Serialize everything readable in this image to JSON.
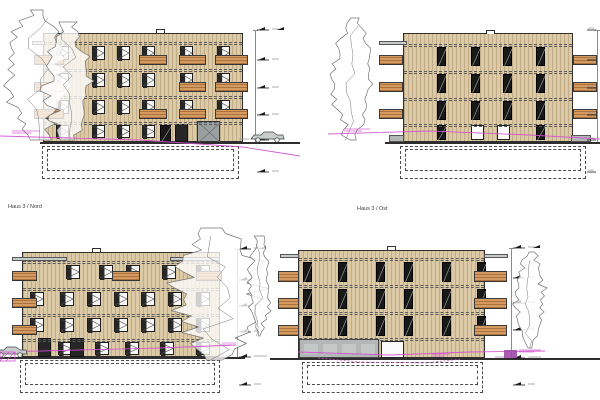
{
  "canvas": {
    "w": 600,
    "h": 400,
    "bg": "#ffffff"
  },
  "palette": {
    "facade": "#dccaa6",
    "facade_stripe": "rgba(124,96,58,0.28)",
    "outline": "#2f2f2f",
    "dashed": "#5a5a5a",
    "balcony": "#d59a5f",
    "balcony_stripe": "rgba(115,66,22,0.45)",
    "balcony_edge": "#3c3c3c",
    "window_frame": "#1f1f1f",
    "glass": "#f7f7f5",
    "sash_dark": "#262626",
    "grey": "#9aa0a0",
    "grey_light": "#c7cccb",
    "concrete": "#b3b8b7",
    "magenta": "#cf4fcf",
    "purple": "#a04aa8",
    "ground": "#2e2e2e",
    "tree": "#757575",
    "marker": "#1a1a1a",
    "marker_text": "#9a9a9a"
  },
  "views": [
    {
      "id": "elevation-top-left",
      "label": null,
      "building": {
        "x": 43,
        "y": 33,
        "w": 200,
        "h": 109
      },
      "floor_lines_y": [
        42,
        69,
        96,
        122
      ],
      "window_grids": [
        {
          "style": "casement",
          "cols": [
            56,
            92,
            117,
            142,
            180,
            217
          ],
          "rows": [
            46,
            73,
            100
          ],
          "w": 13,
          "h": 14
        },
        {
          "style": "casement",
          "cols": [
            56,
            92,
            117,
            142
          ],
          "rows": [
            125
          ],
          "w": 13,
          "h": 13
        }
      ],
      "extra_windows": [
        {
          "style": "dark",
          "x": 160,
          "y": 125,
          "w": 11,
          "h": 17
        },
        {
          "style": "door-dark",
          "x": 175,
          "y": 124,
          "w": 13,
          "h": 18
        },
        {
          "style": "door-grey",
          "x": 197,
          "y": 121,
          "w": 23,
          "h": 21
        }
      ],
      "balconies": [
        {
          "x": 34,
          "w": 30,
          "rows": [
            55,
            82,
            109
          ],
          "h": 10
        },
        {
          "x": 139,
          "w": 28,
          "rows": [
            55,
            109
          ],
          "h": 10
        },
        {
          "x": 179,
          "w": 27,
          "rows": [
            55,
            82,
            109
          ],
          "h": 10
        },
        {
          "x": 215,
          "w": 33,
          "rows": [
            55,
            82,
            109
          ],
          "h": 10
        }
      ],
      "grey_rects": [
        {
          "x": 32,
          "y": 41,
          "w": 13,
          "h": 4,
          "fill": "grey"
        }
      ],
      "vent": {
        "x": 156,
        "y": 29,
        "w": 9,
        "h": 4
      },
      "basement": {
        "x": 42,
        "y": 146,
        "w": 197,
        "h": 33
      },
      "ground": {
        "y": 142,
        "x1": 40,
        "x2": 300
      },
      "dim": {
        "x": 255,
        "y1": 30,
        "y2": 142,
        "magenta_seg": [
          88,
          112
        ]
      },
      "markers": [
        {
          "y": 30,
          "double": true
        },
        {
          "y": 60
        },
        {
          "y": 88
        },
        {
          "y": 115
        },
        {
          "y": 140,
          "long": true
        },
        {
          "y": 172
        }
      ],
      "car": {
        "x": 251,
        "y": 132
      },
      "trees": [
        {
          "x": 1,
          "y": 10,
          "w": 72,
          "h": 130,
          "seed": 11
        },
        {
          "x": 42,
          "y": 22,
          "w": 52,
          "h": 118,
          "seed": 23
        }
      ],
      "magenta_lines": [
        [
          [
            0,
            136
          ],
          [
            140,
            140
          ],
          [
            243,
            147
          ],
          [
            300,
            156
          ]
        ]
      ],
      "magenta_dashed": [],
      "magenta_marks": [
        {
          "x": 12,
          "y": 131,
          "w": 28
        }
      ]
    },
    {
      "id": "elevation-top-right",
      "label": null,
      "building": {
        "x": 403,
        "y": 33,
        "w": 170,
        "h": 109
      },
      "floor_lines_y": [
        44,
        71,
        98,
        124
      ],
      "window_grids": [
        {
          "style": "dark",
          "cols": [
            437,
            471,
            503,
            536
          ],
          "rows": [
            47,
            74,
            101
          ],
          "w": 9,
          "h": 19
        },
        {
          "style": "dark",
          "cols": [
            437,
            536
          ],
          "rows": [
            125
          ],
          "w": 9,
          "h": 15
        },
        {
          "style": "white",
          "cols": [
            471,
            497
          ],
          "rows": [
            125
          ],
          "w": 13,
          "h": 15
        }
      ],
      "extra_windows": [],
      "balconies": [
        {
          "x": 379,
          "w": 24,
          "rows": [
            55,
            82,
            109
          ],
          "h": 10
        },
        {
          "x": 573,
          "w": 24,
          "rows": [
            55,
            82,
            109
          ],
          "h": 10
        }
      ],
      "grey_rects": [
        {
          "x": 379,
          "y": 41,
          "w": 28,
          "h": 4,
          "fill": "grey"
        },
        {
          "x": 389,
          "y": 135,
          "w": 15,
          "h": 7,
          "fill": "concrete"
        },
        {
          "x": 571,
          "y": 135,
          "w": 20,
          "h": 7,
          "fill": "concrete"
        }
      ],
      "vent": {
        "x": 486,
        "y": 30,
        "w": 9,
        "h": 4
      },
      "basement": {
        "x": 400,
        "y": 146,
        "w": 186,
        "h": 33
      },
      "ground": {
        "y": 142,
        "x1": 385,
        "x2": 600
      },
      "dim": {
        "x": 597,
        "y1": 30,
        "y2": 142,
        "magenta_seg": [
          84,
          92
        ]
      },
      "markers": [
        {
          "y": 30,
          "dash_only": true
        },
        {
          "y": 60,
          "dash_only": true
        },
        {
          "y": 88,
          "dash_only": true
        },
        {
          "y": 115,
          "dash_only": true
        },
        {
          "y": 140,
          "dash_only": true
        },
        {
          "y": 172,
          "dash_only": true
        }
      ],
      "car": null,
      "trees": [
        {
          "x": 330,
          "y": 18,
          "w": 44,
          "h": 122,
          "seed": 31
        }
      ],
      "magenta_lines": [
        [
          [
            328,
            134
          ],
          [
            430,
            131
          ],
          [
            530,
            135
          ],
          [
            600,
            139
          ]
        ]
      ],
      "magenta_dashed": [],
      "magenta_marks": [
        {
          "x": 344,
          "y": 129,
          "w": 26
        }
      ]
    },
    {
      "id": "elevation-haus-3-nord",
      "label": {
        "text": "Haus 3 / Nord",
        "x": 8,
        "y": 204
      },
      "building": {
        "x": 22,
        "y": 252,
        "w": 198,
        "h": 105
      },
      "floor_lines_y": [
        261,
        288,
        314,
        339
      ],
      "window_grids": [
        {
          "style": "casement",
          "cols": [
            66,
            99,
            126,
            162,
            196
          ],
          "rows": [
            265
          ],
          "w": 14,
          "h": 14
        },
        {
          "style": "casement",
          "cols": [
            30,
            60,
            87,
            114,
            141,
            168,
            196
          ],
          "rows": [
            292,
            318
          ],
          "w": 14,
          "h": 14
        },
        {
          "style": "casement",
          "cols": [
            58,
            95,
            125,
            160,
            196
          ],
          "rows": [
            342
          ],
          "w": 14,
          "h": 13
        }
      ],
      "extra_windows": [
        {
          "style": "door-dark",
          "x": 38,
          "y": 338,
          "w": 13,
          "h": 19
        },
        {
          "style": "door-dark",
          "x": 70,
          "y": 338,
          "w": 14,
          "h": 19
        }
      ],
      "balconies": [
        {
          "x": 12,
          "w": 25,
          "rows": [
            271,
            298,
            325
          ],
          "h": 10
        },
        {
          "x": 112,
          "w": 28,
          "rows": [
            271
          ],
          "h": 10
        },
        {
          "x": 196,
          "w": 26,
          "rows": [
            271
          ],
          "h": 10
        }
      ],
      "grey_rects": [
        {
          "x": 12,
          "y": 257,
          "w": 55,
          "h": 4,
          "fill": "grey"
        },
        {
          "x": 170,
          "y": 257,
          "w": 50,
          "h": 4,
          "fill": "grey"
        }
      ],
      "vent": {
        "x": 92,
        "y": 248,
        "w": 9,
        "h": 4
      },
      "basement": {
        "x": 20,
        "y": 360,
        "w": 200,
        "h": 33
      },
      "ground": {
        "y": 357,
        "x1": 0,
        "x2": 245
      },
      "dim": {
        "x": 237,
        "y1": 249,
        "y2": 357,
        "magenta_seg": [
          295,
          300
        ]
      },
      "markers": [
        {
          "y": 249,
          "double": true
        },
        {
          "y": 280
        },
        {
          "y": 306
        },
        {
          "y": 332
        },
        {
          "y": 357,
          "long": true
        },
        {
          "y": 385
        }
      ],
      "car": {
        "x": -6,
        "y": 347
      },
      "hatch": {
        "x": 0,
        "y": 352,
        "w": 15,
        "h": 9
      },
      "trees": [
        {
          "x": 168,
          "y": 228,
          "w": 100,
          "h": 132,
          "seed": 41
        },
        {
          "x": 246,
          "y": 236,
          "w": 26,
          "h": 100,
          "seed": 53
        }
      ],
      "magenta_lines": [
        [
          [
            0,
            352
          ],
          [
            80,
            350
          ],
          [
            160,
            348
          ],
          [
            236,
            345
          ]
        ]
      ],
      "magenta_dashed": [],
      "magenta_marks": [
        {
          "x": 222,
          "y": 343,
          "w": 14
        }
      ]
    },
    {
      "id": "elevation-haus-3-ost",
      "label": {
        "text": "Haus 3 / Ost",
        "x": 357,
        "y": 206
      },
      "building": {
        "x": 298,
        "y": 250,
        "w": 187,
        "h": 108
      },
      "floor_lines_y": [
        258,
        285,
        312,
        338
      ],
      "window_grids": [
        {
          "style": "dark",
          "cols": [
            303,
            338,
            376,
            404,
            442,
            477
          ],
          "rows": [
            262,
            289,
            316
          ],
          "w": 9,
          "h": 20
        }
      ],
      "extra_windows": [
        {
          "style": "door-white",
          "x": 381,
          "y": 341,
          "w": 23,
          "h": 17
        }
      ],
      "balconies": [
        {
          "x": 278,
          "w": 21,
          "rows": [
            271,
            298,
            325
          ],
          "h": 11
        },
        {
          "x": 474,
          "w": 33,
          "rows": [
            271,
            298,
            325
          ],
          "h": 11
        }
      ],
      "grey_rects": [
        {
          "x": 280,
          "y": 254,
          "w": 19,
          "h": 4,
          "fill": "grey"
        },
        {
          "x": 484,
          "y": 254,
          "w": 24,
          "h": 4,
          "fill": "grey"
        }
      ],
      "garage": {
        "x": 299,
        "y": 339,
        "w": 80,
        "h": 19,
        "panels": 4
      },
      "vent": {
        "x": 387,
        "y": 246,
        "w": 9,
        "h": 4
      },
      "basement": {
        "x": 302,
        "y": 362,
        "w": 181,
        "h": 31
      },
      "ground": {
        "y": 358,
        "x1": 270,
        "x2": 600
      },
      "dim": {
        "x": 511,
        "y1": 248,
        "y2": 358,
        "magenta_seg": [
          302,
          308
        ]
      },
      "markers": [
        {
          "y": 248,
          "double": true
        },
        {
          "y": 278
        },
        {
          "y": 303
        },
        {
          "y": 330
        },
        {
          "y": 358,
          "long": true
        },
        {
          "y": 385
        }
      ],
      "car": null,
      "purple_rect": {
        "x": 504,
        "y": 350,
        "w": 13,
        "h": 8
      },
      "trees": [
        {
          "x": 514,
          "y": 252,
          "w": 32,
          "h": 96,
          "seed": 61
        }
      ],
      "magenta_lines": [
        [
          [
            298,
            352
          ],
          [
            390,
            355
          ],
          [
            470,
            352
          ],
          [
            545,
            351
          ]
        ]
      ],
      "magenta_dashed": [
        [
          [
            318,
            358
          ],
          [
            360,
            362
          ],
          [
            425,
            363
          ],
          [
            462,
            359
          ]
        ]
      ],
      "magenta_marks": [
        {
          "x": 519,
          "y": 350,
          "w": 22
        },
        {
          "x": 432,
          "y": 354,
          "w": 18
        }
      ]
    }
  ]
}
